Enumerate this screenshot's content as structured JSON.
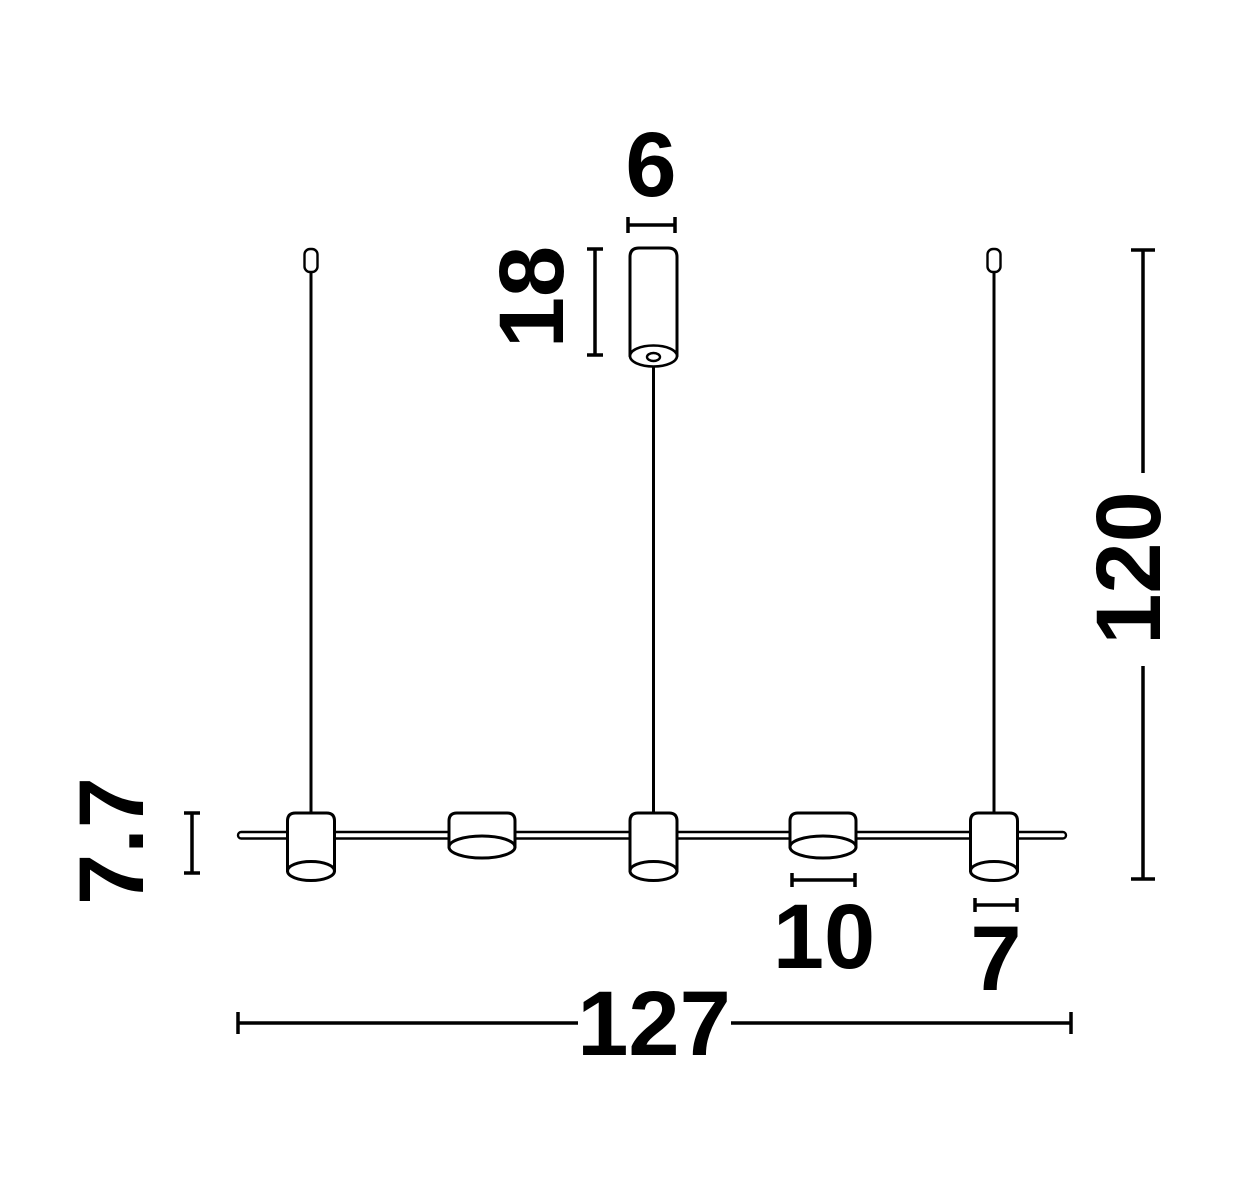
{
  "labels": {
    "canopy_diameter": "6",
    "canopy_height": "18",
    "drop_height": "120",
    "shade_height": "7.7",
    "wide_shade_diameter": "10",
    "narrow_shade_diameter": "7",
    "total_width": "127"
  },
  "colors": {
    "line": "#000000",
    "background": "#ffffff"
  }
}
